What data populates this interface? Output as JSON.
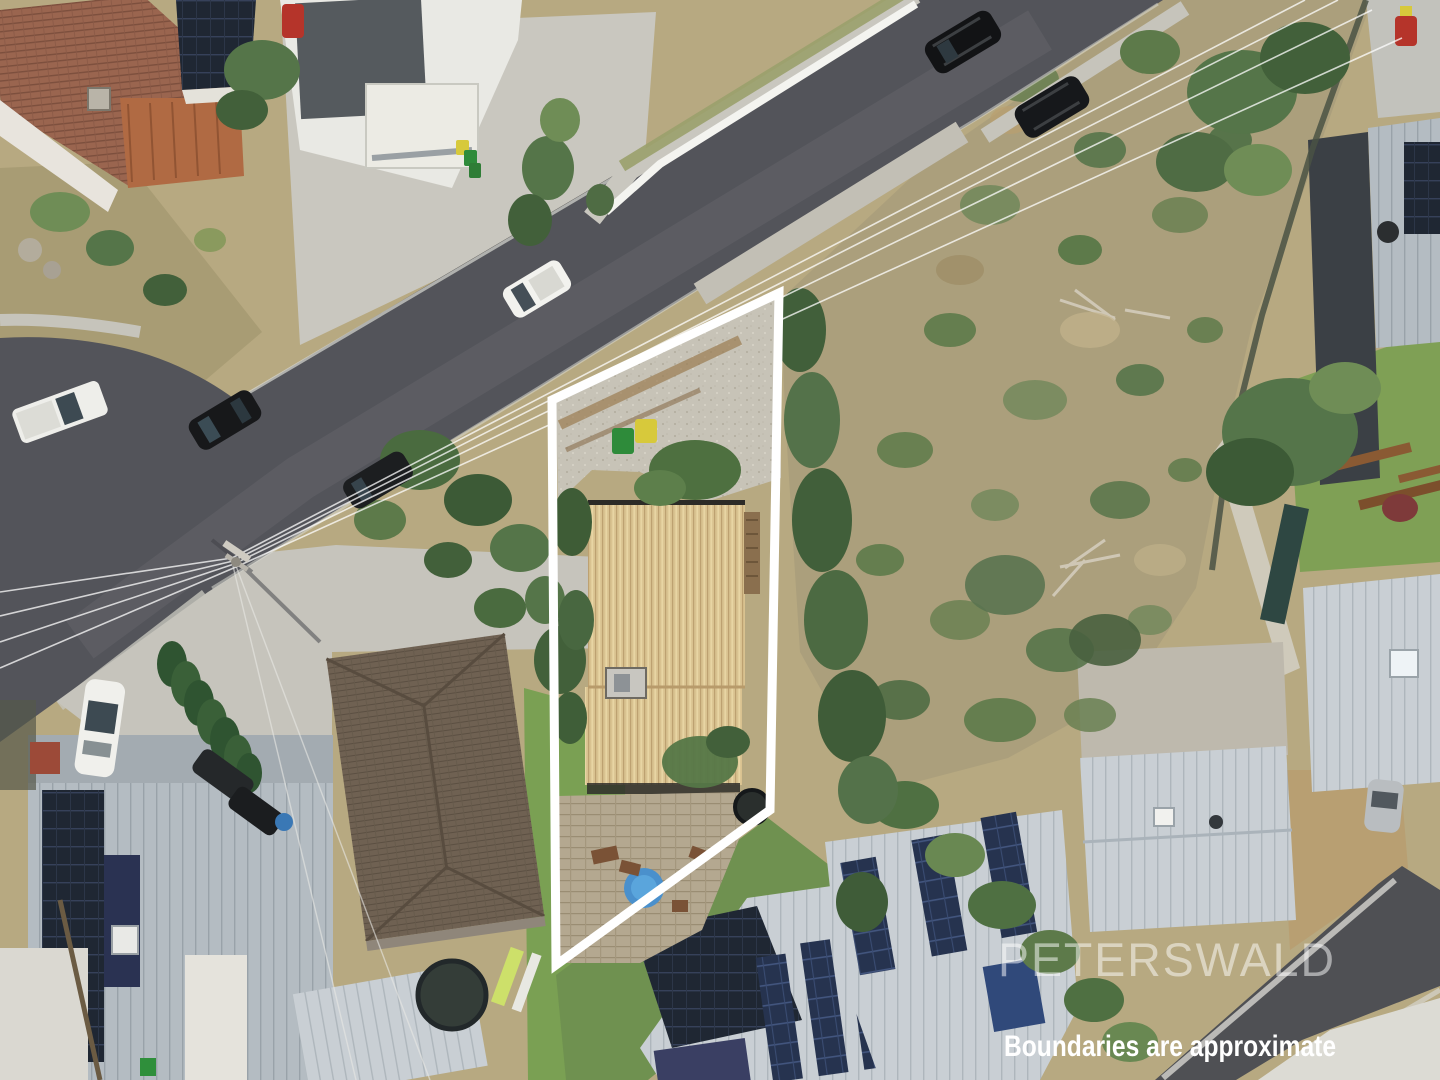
{
  "photo": {
    "kind": "aerial-drone-photograph",
    "subject": "suburban property with white marketing boundary overlay"
  },
  "watermark": {
    "text": "PETERSWALD",
    "color": "#ffffff"
  },
  "disclaimer": {
    "text": "Boundaries are approximate",
    "color": "#ffffff"
  },
  "boundary": {
    "points": "779,293 552,400 556,965 770,810",
    "color": "#ffffff",
    "stroke_width": "9"
  },
  "palette": {
    "road": "#53545a",
    "road_worn": "#6d6e72",
    "concrete": "#c9c7bf",
    "dry_grass": "#b7a981",
    "scrub": "#ab9f7c",
    "lawn": "#7da457",
    "tree_dark": "#42603a",
    "tree_mid": "#557549",
    "tree_light": "#6f8d56",
    "subject_roof": "#d9c290",
    "tile_roof_brown": "#6f6152",
    "terracotta_roof": "#9a654f",
    "metal_roof_light": "#c9cfd4",
    "solar_panel_blue": "#2d4a7c",
    "solar_panel_dark": "#1f2733",
    "pool_blue": "#4a90cc",
    "spa_dark": "#2a2f2d",
    "bin_green": "#2e8b3a",
    "bin_yellow": "#d7c93b",
    "retaining_wall_white": "#f4f4f0"
  }
}
